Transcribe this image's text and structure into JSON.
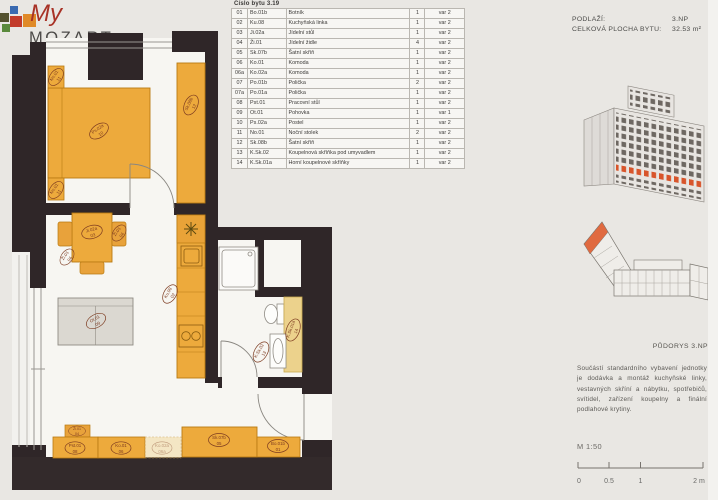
{
  "logo": {
    "script": "My",
    "word": "MOZART"
  },
  "header": {
    "floor_label": "PODLAŽÍ:",
    "floor_value": "3.NP",
    "area_label": "CELKOVÁ PLOCHA BYTU:",
    "area_value": "32.53 m²"
  },
  "table": {
    "caption": "Číslo bytu 3.19",
    "rows": [
      {
        "p": "01",
        "c": "Bo.01b",
        "n": "Botník",
        "q": "1",
        "v": "var 2"
      },
      {
        "p": "02",
        "c": "Ku.08",
        "n": "Kuchyňská linka",
        "q": "1",
        "v": "var 2"
      },
      {
        "p": "03",
        "c": "Ji.02a",
        "n": "Jídelní stůl",
        "q": "1",
        "v": "var 2"
      },
      {
        "p": "04",
        "c": "Ži.01",
        "n": "Jídelní židle",
        "q": "4",
        "v": "var 2"
      },
      {
        "p": "05",
        "c": "Sk.07b",
        "n": "Šatní skříň",
        "q": "1",
        "v": "var 2"
      },
      {
        "p": "06",
        "c": "Ko.01",
        "n": "Komoda",
        "q": "1",
        "v": "var 2"
      },
      {
        "p": "06a",
        "c": "Ko.02a",
        "n": "Komoda",
        "q": "1",
        "v": "var 2"
      },
      {
        "p": "07",
        "c": "Po.01b",
        "n": "Polička",
        "q": "2",
        "v": "var 2"
      },
      {
        "p": "07a",
        "c": "Po.01a",
        "n": "Polička",
        "q": "1",
        "v": "var 2"
      },
      {
        "p": "08",
        "c": "Pst.01",
        "n": "Pracovní stůl",
        "q": "1",
        "v": "var 2"
      },
      {
        "p": "09",
        "c": "Ot.01",
        "n": "Pohovka",
        "q": "1",
        "v": "var 1"
      },
      {
        "p": "10",
        "c": "Ps.02a",
        "n": "Postel",
        "q": "1",
        "v": "var 2"
      },
      {
        "p": "11",
        "c": "No.01",
        "n": "Noční stolek",
        "q": "2",
        "v": "var 2"
      },
      {
        "p": "12",
        "c": "Sk.08b",
        "n": "Šatní skříň",
        "q": "1",
        "v": "var 2"
      },
      {
        "p": "13",
        "c": "K.Sk.02",
        "n": "Koupelnová skříňka pod umyvadlem",
        "q": "1",
        "v": "var 2"
      },
      {
        "p": "14",
        "c": "K.Sk.01a",
        "n": "Horní koupelnové skříňky",
        "q": "1",
        "v": "var 2"
      }
    ]
  },
  "plan": {
    "labels": {
      "bed": {
        "code": "Ps.02a",
        "num": "10"
      },
      "ns_top": {
        "code": "No.01",
        "num": "11"
      },
      "ns_bottom": {
        "code": "No.01",
        "num": "11"
      },
      "wardrobe_bed": {
        "code": "Sk.08b",
        "num": "12"
      },
      "table": {
        "code": "Ji.02a",
        "num": "03"
      },
      "chair_left": {
        "code": "Ži.01",
        "num": "04"
      },
      "chair_right": {
        "code": "Ži.01",
        "num": "04"
      },
      "sofa": {
        "code": "Ot.01",
        "num": "09"
      },
      "kitchen": {
        "code": "Ku.08",
        "num": "02"
      },
      "bath_cab_low": {
        "code": "K.Sk.02",
        "num": "13"
      },
      "bath_cab_high": {
        "code": "K.Sk.01a",
        "num": "14"
      },
      "chair_desk": {
        "code": "Ži.01",
        "num": "04"
      },
      "desk": {
        "code": "Pst.01",
        "num": "08"
      },
      "komoda": {
        "code": "Ko.01",
        "num": "06"
      },
      "komoda_alt": {
        "code": "Ko.02a",
        "num": "06a"
      },
      "hall_wardrobe": {
        "code": "Sk.07b",
        "num": "05"
      },
      "shoe_cab": {
        "code": "Bo.01b",
        "num": "01"
      }
    }
  },
  "key_plan": {
    "caption": "PŮDORYS 3.NP"
  },
  "notes": {
    "text": "Součástí standardního vybavení jednotky je dodávka a montáž kuchyňské linky, vestavných skříní a nábytku, spotřebičů, svítidel, zařízení koupelny a finální podlahové krytiny."
  },
  "scale": {
    "label": "M 1:50",
    "ticks": [
      "0",
      "0.5",
      "1",
      "2 m"
    ]
  },
  "colors": {
    "furniture_orange": "#edaa3c",
    "cabinet_yellow": "#ecd28c",
    "wall_dark": "#2f2628",
    "highlight_orange": "#d8552b",
    "sofa_gray": "#dbd8d1",
    "label_rust": "#7d3b20"
  }
}
